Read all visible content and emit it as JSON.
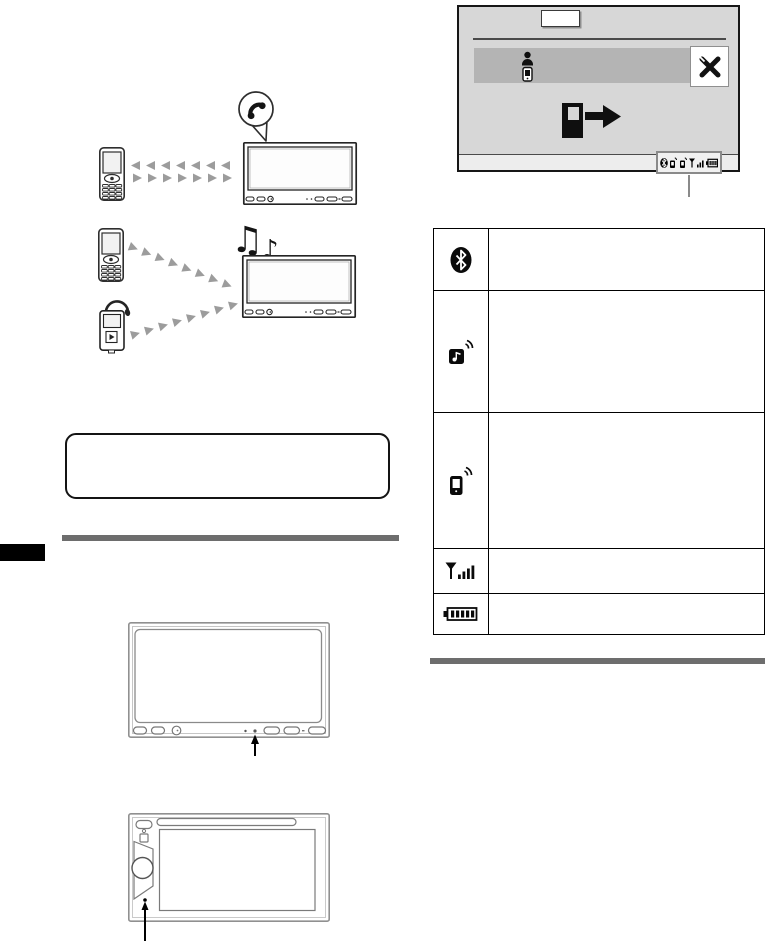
{
  "colors": {
    "page_bg": "#ffffff",
    "line_art": "#2e2e2e",
    "arrow_gray": "#9c9c9c",
    "panel_gray": "#8f8f8f",
    "screen_bg": "#d7d7d7",
    "highlight_row_bg": "#b4b4b4",
    "status_strip_bg": "#ededed",
    "rule_gray": "#6d6d6d",
    "marker_black": "#000000"
  },
  "diagrams": {
    "handsfree_call": {
      "bubble_icon": "phone-handset-icon",
      "devices": [
        "mobile-phone",
        "av-receiver"
      ]
    },
    "audio_streaming": {
      "note_pair_glyph": "♫",
      "note_single_glyph": "♪",
      "devices": [
        "mobile-phone",
        "portable-audio-player",
        "av-receiver"
      ]
    }
  },
  "note_box": {
    "text": ""
  },
  "display_mockup": {
    "source_button_label": "",
    "list_row": {
      "left_icons": [
        "person-icon",
        "cellphone-icon"
      ],
      "right_icon": "settings-icon"
    },
    "center_icon": "phone-connect-arrow-icon",
    "status_cluster_icons": [
      "bluetooth-icon",
      "audio-streaming-icon",
      "handsfree-phone-icon",
      "signal-strength-icon",
      "battery-icon"
    ]
  },
  "status_table": {
    "rows": [
      {
        "icon": "bluetooth-icon",
        "description": ""
      },
      {
        "icon": "audio-streaming-icon",
        "description": ""
      },
      {
        "icon": "handsfree-phone-icon",
        "description": ""
      },
      {
        "icon": "signal-strength-icon",
        "description": ""
      },
      {
        "icon": "battery-level-icon",
        "description": ""
      }
    ]
  },
  "front_panels": [
    "double-din-receiver",
    "single-screen-receiver"
  ]
}
